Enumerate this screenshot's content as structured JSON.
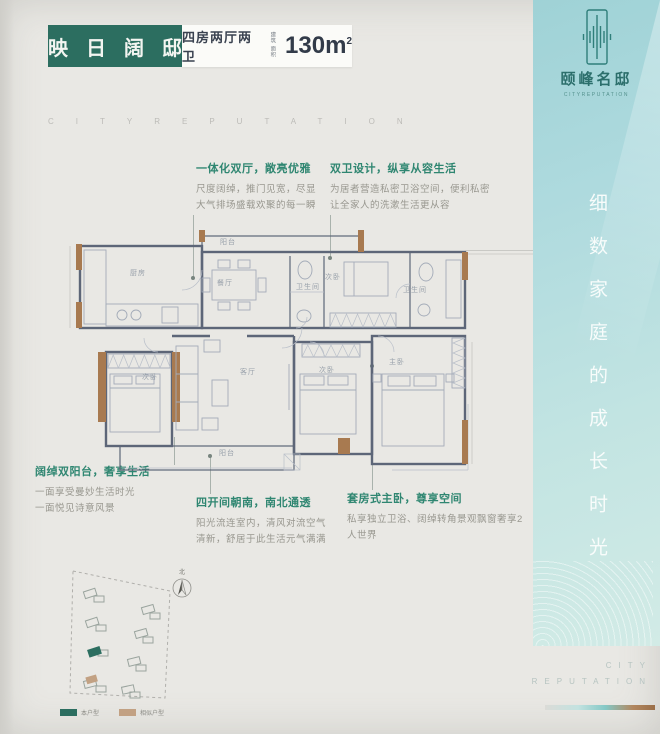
{
  "header": {
    "title_chars": [
      "映",
      "日",
      "阔",
      "邸"
    ],
    "subtitle": "四房两厅两卫",
    "area_label_1": "建筑",
    "area_label_2": "面积",
    "area_value": "130m",
    "area_sup": "2"
  },
  "watermark": "CITYREPUTATION",
  "brand": {
    "name_zh": "颐峰名邸",
    "name_en": "CITYREPUTATION",
    "slogan_vertical": "细数家庭的成长时光",
    "footer_line1": "CITY",
    "footer_line2": "REPUTATION"
  },
  "annotations": [
    {
      "title": "一体化双厅，敞亮优雅",
      "body": "尺度阔绰，推门见宽，尽显\n大气排场盛载欢聚的每一瞬"
    },
    {
      "title": "双卫设计，纵享从容生活",
      "body": "为居者营造私密卫浴空间，便利私密\n让全家人的洗漱生活更从容"
    },
    {
      "title": "阔绰双阳台，奢享生活",
      "body": "一面享受曼妙生活时光\n一面悦见诗意风景"
    },
    {
      "title": "四开间朝南，南北通透",
      "body": "阳光流连室内，清风对流空气\n清新，舒居于此生活元气满满"
    },
    {
      "title": "套房式主卧，尊享空间",
      "body": "私享独立卫浴、阔绰转角景观飘窗奢享2人世界"
    }
  ],
  "floorplan": {
    "rooms": [
      {
        "label": "厨房"
      },
      {
        "label": "阳台"
      },
      {
        "label": "餐厅"
      },
      {
        "label": "卫生间"
      },
      {
        "label": "次卧"
      },
      {
        "label": "卫生间"
      },
      {
        "label": "次卧"
      },
      {
        "label": "客厅"
      },
      {
        "label": "次卧"
      },
      {
        "label": "主卧"
      },
      {
        "label": "阳台"
      }
    ]
  },
  "siteplan": {
    "compass": "北",
    "legend": [
      {
        "label": "本户型",
        "color": "#2c6e60"
      },
      {
        "label": "相似户型",
        "color": "#c2a183"
      }
    ]
  },
  "colors": {
    "accent_green": "#2c6e60",
    "annotation_green": "#2f8671",
    "panel_teal": "#a8d8db",
    "wood_brown": "#a87a50"
  }
}
